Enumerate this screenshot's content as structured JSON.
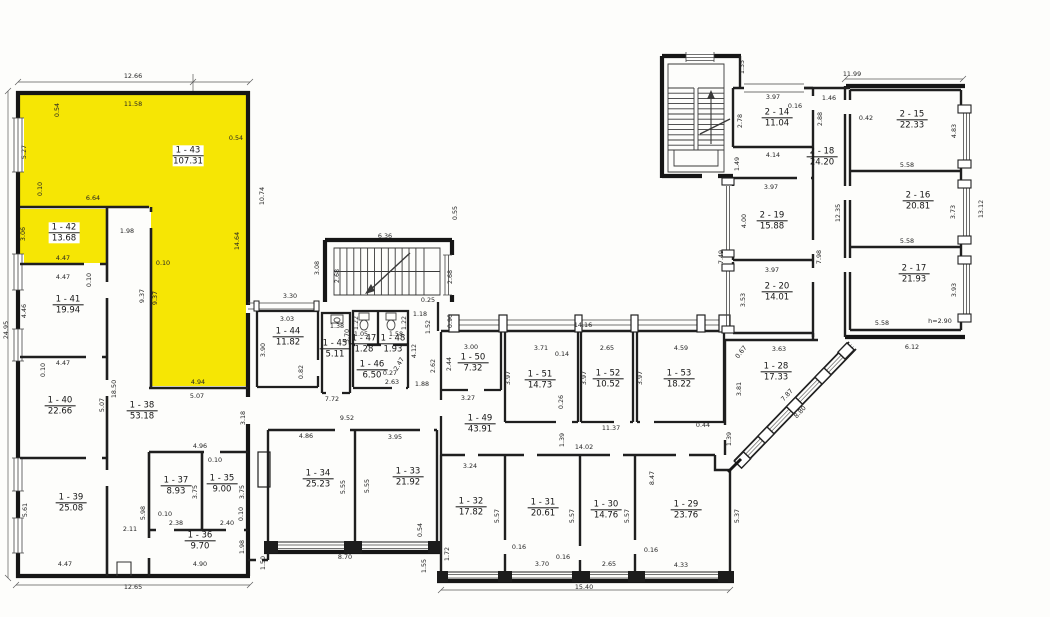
{
  "document": {
    "type": "scanned floor plan",
    "wing_left_prefix": "1",
    "wing_right_prefix": "2"
  },
  "colors": {
    "highlight": "#f6e604",
    "paper": "#fdfdfb",
    "ink": "#1c1c1c"
  },
  "rooms": [
    {
      "id": "1 - 43",
      "area": "107.31",
      "x": 188,
      "y": 156,
      "hl": true
    },
    {
      "id": "1 - 42",
      "area": "13.68",
      "x": 64,
      "y": 233,
      "hl": true
    },
    {
      "id": "1 - 41",
      "area": "19.94",
      "x": 68,
      "y": 305
    },
    {
      "id": "1 - 40",
      "area": "22.66",
      "x": 60,
      "y": 406
    },
    {
      "id": "1 - 39",
      "area": "25.08",
      "x": 71,
      "y": 503
    },
    {
      "id": "1 - 38",
      "area": "53.18",
      "x": 142,
      "y": 411
    },
    {
      "id": "1 - 37",
      "area": "8.93",
      "x": 176,
      "y": 486
    },
    {
      "id": "1 - 35",
      "area": "9.00",
      "x": 222,
      "y": 484
    },
    {
      "id": "1 - 36",
      "area": "9.70",
      "x": 200,
      "y": 541
    },
    {
      "id": "1 - 44",
      "area": "11.82",
      "x": 288,
      "y": 337
    },
    {
      "id": "1 - 45",
      "area": "5.11",
      "x": 335,
      "y": 349
    },
    {
      "id": "1 - 47",
      "area": "1.28",
      "x": 364,
      "y": 344
    },
    {
      "id": "1 - 48",
      "area": "1.93",
      "x": 393,
      "y": 344
    },
    {
      "id": "1 - 46",
      "area": "6.50",
      "x": 372,
      "y": 370
    },
    {
      "id": "1 - 50",
      "area": "7.32",
      "x": 473,
      "y": 363
    },
    {
      "id": "1 - 51",
      "area": "14.73",
      "x": 540,
      "y": 380
    },
    {
      "id": "1 - 52",
      "area": "10.52",
      "x": 608,
      "y": 379
    },
    {
      "id": "1 - 53",
      "area": "18.22",
      "x": 679,
      "y": 379
    },
    {
      "id": "1 - 49",
      "area": "43.91",
      "x": 480,
      "y": 424
    },
    {
      "id": "1 - 34",
      "area": "25.23",
      "x": 318,
      "y": 479
    },
    {
      "id": "1 - 33",
      "area": "21.92",
      "x": 408,
      "y": 477
    },
    {
      "id": "1 - 32",
      "area": "17.82",
      "x": 471,
      "y": 507
    },
    {
      "id": "1 - 31",
      "area": "20.61",
      "x": 543,
      "y": 508
    },
    {
      "id": "1 - 30",
      "area": "14.76",
      "x": 606,
      "y": 510
    },
    {
      "id": "1 - 29",
      "area": "23.76",
      "x": 686,
      "y": 510
    },
    {
      "id": "1 - 28",
      "area": "17.33",
      "x": 776,
      "y": 372
    },
    {
      "id": "2 - 14",
      "area": "11.04",
      "x": 777,
      "y": 118
    },
    {
      "id": "2 - 18",
      "area": "24.20",
      "x": 822,
      "y": 157
    },
    {
      "id": "2 - 15",
      "area": "22.33",
      "x": 912,
      "y": 120
    },
    {
      "id": "2 - 16",
      "area": "20.81",
      "x": 918,
      "y": 201
    },
    {
      "id": "2 - 17",
      "area": "21.93",
      "x": 914,
      "y": 274
    },
    {
      "id": "2 - 19",
      "area": "15.88",
      "x": 772,
      "y": 221
    },
    {
      "id": "2 - 20",
      "area": "14.01",
      "x": 777,
      "y": 292
    }
  ],
  "dimensions": [
    {
      "t": "12.66",
      "x": 133,
      "y": 76
    },
    {
      "t": "11.58",
      "x": 133,
      "y": 104
    },
    {
      "t": "0.54",
      "x": 57,
      "y": 110,
      "r": -90
    },
    {
      "t": "5.27",
      "x": 24,
      "y": 152,
      "r": -90
    },
    {
      "t": "0.54",
      "x": 236,
      "y": 138
    },
    {
      "t": "10.74",
      "x": 262,
      "y": 196,
      "r": -90
    },
    {
      "t": "6.64",
      "x": 93,
      "y": 198
    },
    {
      "t": "0.10",
      "x": 40,
      "y": 189,
      "r": -90
    },
    {
      "t": "1.98",
      "x": 127,
      "y": 231
    },
    {
      "t": "14.64",
      "x": 237,
      "y": 241,
      "r": -90
    },
    {
      "t": "3.06",
      "x": 23,
      "y": 234,
      "r": -90
    },
    {
      "t": "4.47",
      "x": 63,
      "y": 258
    },
    {
      "t": "4.47",
      "x": 63,
      "y": 277
    },
    {
      "t": "0.10",
      "x": 89,
      "y": 280,
      "r": -90
    },
    {
      "t": "0.10",
      "x": 163,
      "y": 263
    },
    {
      "t": "9.37",
      "x": 142,
      "y": 296,
      "r": -90
    },
    {
      "t": "9.37",
      "x": 155,
      "y": 298,
      "r": -90
    },
    {
      "t": "4.46",
      "x": 24,
      "y": 311,
      "r": -90
    },
    {
      "t": "24.95",
      "x": 6,
      "y": 330,
      "r": -90
    },
    {
      "t": "4.47",
      "x": 63,
      "y": 363
    },
    {
      "t": "0.10",
      "x": 43,
      "y": 370,
      "r": -90
    },
    {
      "t": "18.50",
      "x": 114,
      "y": 389,
      "r": -90
    },
    {
      "t": "5.07",
      "x": 102,
      "y": 405,
      "r": -90
    },
    {
      "t": "4.94",
      "x": 198,
      "y": 382
    },
    {
      "t": "5.07",
      "x": 197,
      "y": 396
    },
    {
      "t": "3.18",
      "x": 243,
      "y": 418,
      "r": -90
    },
    {
      "t": "4.96",
      "x": 200,
      "y": 446
    },
    {
      "t": "0.10",
      "x": 215,
      "y": 460
    },
    {
      "t": "3.75",
      "x": 195,
      "y": 492,
      "r": -90
    },
    {
      "t": "3.75",
      "x": 242,
      "y": 492,
      "r": -90
    },
    {
      "t": "5.61",
      "x": 25,
      "y": 510,
      "r": -90
    },
    {
      "t": "5.98",
      "x": 143,
      "y": 513,
      "r": -90
    },
    {
      "t": "0.10",
      "x": 165,
      "y": 514
    },
    {
      "t": "2.38",
      "x": 176,
      "y": 523
    },
    {
      "t": "2.40",
      "x": 227,
      "y": 523
    },
    {
      "t": "0.10",
      "x": 241,
      "y": 514,
      "r": -90
    },
    {
      "t": "2.11",
      "x": 130,
      "y": 529
    },
    {
      "t": "1.98",
      "x": 242,
      "y": 547,
      "r": -90
    },
    {
      "t": "4.47",
      "x": 65,
      "y": 564
    },
    {
      "t": "4.90",
      "x": 200,
      "y": 564
    },
    {
      "t": "12.65",
      "x": 133,
      "y": 587
    },
    {
      "t": "1.50",
      "x": 263,
      "y": 563,
      "r": -90
    },
    {
      "t": "6.36",
      "x": 385,
      "y": 236
    },
    {
      "t": "0.55",
      "x": 455,
      "y": 213,
      "r": -90
    },
    {
      "t": "3.08",
      "x": 317,
      "y": 268,
      "r": -90
    },
    {
      "t": "2.68",
      "x": 337,
      "y": 276,
      "r": -90
    },
    {
      "t": "2.68",
      "x": 450,
      "y": 277,
      "r": -90
    },
    {
      "t": "3.30",
      "x": 290,
      "y": 296
    },
    {
      "t": "3.03",
      "x": 287,
      "y": 319
    },
    {
      "t": "3.90",
      "x": 263,
      "y": 350,
      "r": -90
    },
    {
      "t": "0.25",
      "x": 428,
      "y": 300
    },
    {
      "t": "0.82",
      "x": 301,
      "y": 372,
      "r": -90
    },
    {
      "t": "1.18",
      "x": 420,
      "y": 314
    },
    {
      "t": "1.52",
      "x": 428,
      "y": 327,
      "r": -90
    },
    {
      "t": "0.90",
      "x": 450,
      "y": 321,
      "r": -90
    },
    {
      "t": "1.38",
      "x": 337,
      "y": 326
    },
    {
      "t": "3.70",
      "x": 347,
      "y": 336,
      "r": -90
    },
    {
      "t": "1.22",
      "x": 356,
      "y": 323,
      "r": -90
    },
    {
      "t": "1.22",
      "x": 404,
      "y": 323,
      "r": -90
    },
    {
      "t": "1.05",
      "x": 361,
      "y": 334
    },
    {
      "t": "1.58",
      "x": 396,
      "y": 334
    },
    {
      "t": "2.47",
      "x": 399,
      "y": 364,
      "r": -60
    },
    {
      "t": "0.27",
      "x": 390,
      "y": 373
    },
    {
      "t": "2.63",
      "x": 392,
      "y": 382
    },
    {
      "t": "4.12",
      "x": 414,
      "y": 351,
      "r": -90
    },
    {
      "t": "1.88",
      "x": 422,
      "y": 384
    },
    {
      "t": "2.62",
      "x": 433,
      "y": 366,
      "r": -90
    },
    {
      "t": "2.44",
      "x": 449,
      "y": 364,
      "r": -90
    },
    {
      "t": "7.72",
      "x": 332,
      "y": 399
    },
    {
      "t": "9.52",
      "x": 347,
      "y": 418
    },
    {
      "t": "4.86",
      "x": 306,
      "y": 436
    },
    {
      "t": "3.95",
      "x": 395,
      "y": 437
    },
    {
      "t": "5.55",
      "x": 343,
      "y": 487,
      "r": -90
    },
    {
      "t": "5.55",
      "x": 367,
      "y": 486,
      "r": -90
    },
    {
      "t": "0.54",
      "x": 420,
      "y": 530,
      "r": -90
    },
    {
      "t": "8.70",
      "x": 345,
      "y": 557
    },
    {
      "t": "1.55",
      "x": 424,
      "y": 566,
      "r": -90
    },
    {
      "t": "1.72",
      "x": 447,
      "y": 554,
      "r": -90
    },
    {
      "t": "14.16",
      "x": 583,
      "y": 325
    },
    {
      "t": "3.00",
      "x": 471,
      "y": 347
    },
    {
      "t": "3.27",
      "x": 468,
      "y": 398
    },
    {
      "t": "3.71",
      "x": 541,
      "y": 348
    },
    {
      "t": "0.14",
      "x": 562,
      "y": 354
    },
    {
      "t": "3.97",
      "x": 508,
      "y": 378,
      "r": -90
    },
    {
      "t": "0.26",
      "x": 561,
      "y": 402,
      "r": -90
    },
    {
      "t": "2.65",
      "x": 607,
      "y": 348
    },
    {
      "t": "3.97",
      "x": 584,
      "y": 378,
      "r": -90
    },
    {
      "t": "4.59",
      "x": 681,
      "y": 348
    },
    {
      "t": "3.97",
      "x": 640,
      "y": 378,
      "r": -90
    },
    {
      "t": "11.37",
      "x": 611,
      "y": 428
    },
    {
      "t": "0.44",
      "x": 703,
      "y": 425
    },
    {
      "t": "1.39",
      "x": 562,
      "y": 440,
      "r": -90
    },
    {
      "t": "14.02",
      "x": 584,
      "y": 447
    },
    {
      "t": "3.24",
      "x": 470,
      "y": 466
    },
    {
      "t": "5.57",
      "x": 497,
      "y": 516,
      "r": -90
    },
    {
      "t": "0.16",
      "x": 519,
      "y": 547
    },
    {
      "t": "5.57",
      "x": 572,
      "y": 516,
      "r": -90
    },
    {
      "t": "0.16",
      "x": 563,
      "y": 557
    },
    {
      "t": "3.70",
      "x": 542,
      "y": 564
    },
    {
      "t": "5.57",
      "x": 627,
      "y": 516,
      "r": -90
    },
    {
      "t": "2.65",
      "x": 609,
      "y": 564
    },
    {
      "t": "0.16",
      "x": 651,
      "y": 550
    },
    {
      "t": "8.47",
      "x": 652,
      "y": 478,
      "r": -90
    },
    {
      "t": "4.33",
      "x": 681,
      "y": 565
    },
    {
      "t": "5.37",
      "x": 737,
      "y": 516,
      "r": -90
    },
    {
      "t": "15.40",
      "x": 584,
      "y": 587
    },
    {
      "t": "1.35",
      "x": 742,
      "y": 67,
      "r": -90
    },
    {
      "t": "11.99",
      "x": 852,
      "y": 74
    },
    {
      "t": "3.97",
      "x": 773,
      "y": 97
    },
    {
      "t": "0.16",
      "x": 795,
      "y": 106
    },
    {
      "t": "2.78",
      "x": 740,
      "y": 121,
      "r": -90
    },
    {
      "t": "2.88",
      "x": 820,
      "y": 119,
      "r": -90
    },
    {
      "t": "1.46",
      "x": 829,
      "y": 98
    },
    {
      "t": "4.14",
      "x": 773,
      "y": 155
    },
    {
      "t": "1.49",
      "x": 737,
      "y": 164,
      "r": -90
    },
    {
      "t": "0.42",
      "x": 866,
      "y": 118
    },
    {
      "t": "4.83",
      "x": 954,
      "y": 131,
      "r": -90
    },
    {
      "t": "5.58",
      "x": 907,
      "y": 165
    },
    {
      "t": "3.73",
      "x": 953,
      "y": 212,
      "r": -90
    },
    {
      "t": "13.12",
      "x": 981,
      "y": 209,
      "r": -90
    },
    {
      "t": "5.58",
      "x": 907,
      "y": 241
    },
    {
      "t": "12.35",
      "x": 838,
      "y": 213,
      "r": -90
    },
    {
      "t": "3.97",
      "x": 771,
      "y": 187
    },
    {
      "t": "4.00",
      "x": 744,
      "y": 221,
      "r": -90
    },
    {
      "t": "7.98",
      "x": 819,
      "y": 257,
      "r": -90
    },
    {
      "t": "7.49",
      "x": 721,
      "y": 257,
      "r": -90
    },
    {
      "t": "3.97",
      "x": 772,
      "y": 270
    },
    {
      "t": "3.53",
      "x": 743,
      "y": 300,
      "r": -90
    },
    {
      "t": "3.93",
      "x": 954,
      "y": 290,
      "r": -90
    },
    {
      "t": "5.58",
      "x": 882,
      "y": 323
    },
    {
      "t": "h=2.90",
      "x": 940,
      "y": 321
    },
    {
      "t": "6.12",
      "x": 912,
      "y": 347
    },
    {
      "t": "0.67",
      "x": 741,
      "y": 352,
      "r": -52
    },
    {
      "t": "3.63",
      "x": 779,
      "y": 349
    },
    {
      "t": "3.81",
      "x": 739,
      "y": 389,
      "r": -90
    },
    {
      "t": "7.87",
      "x": 787,
      "y": 395,
      "r": -47
    },
    {
      "t": "8.80",
      "x": 800,
      "y": 412,
      "r": -47
    },
    {
      "t": "1.39",
      "x": 729,
      "y": 439,
      "r": -90
    }
  ]
}
